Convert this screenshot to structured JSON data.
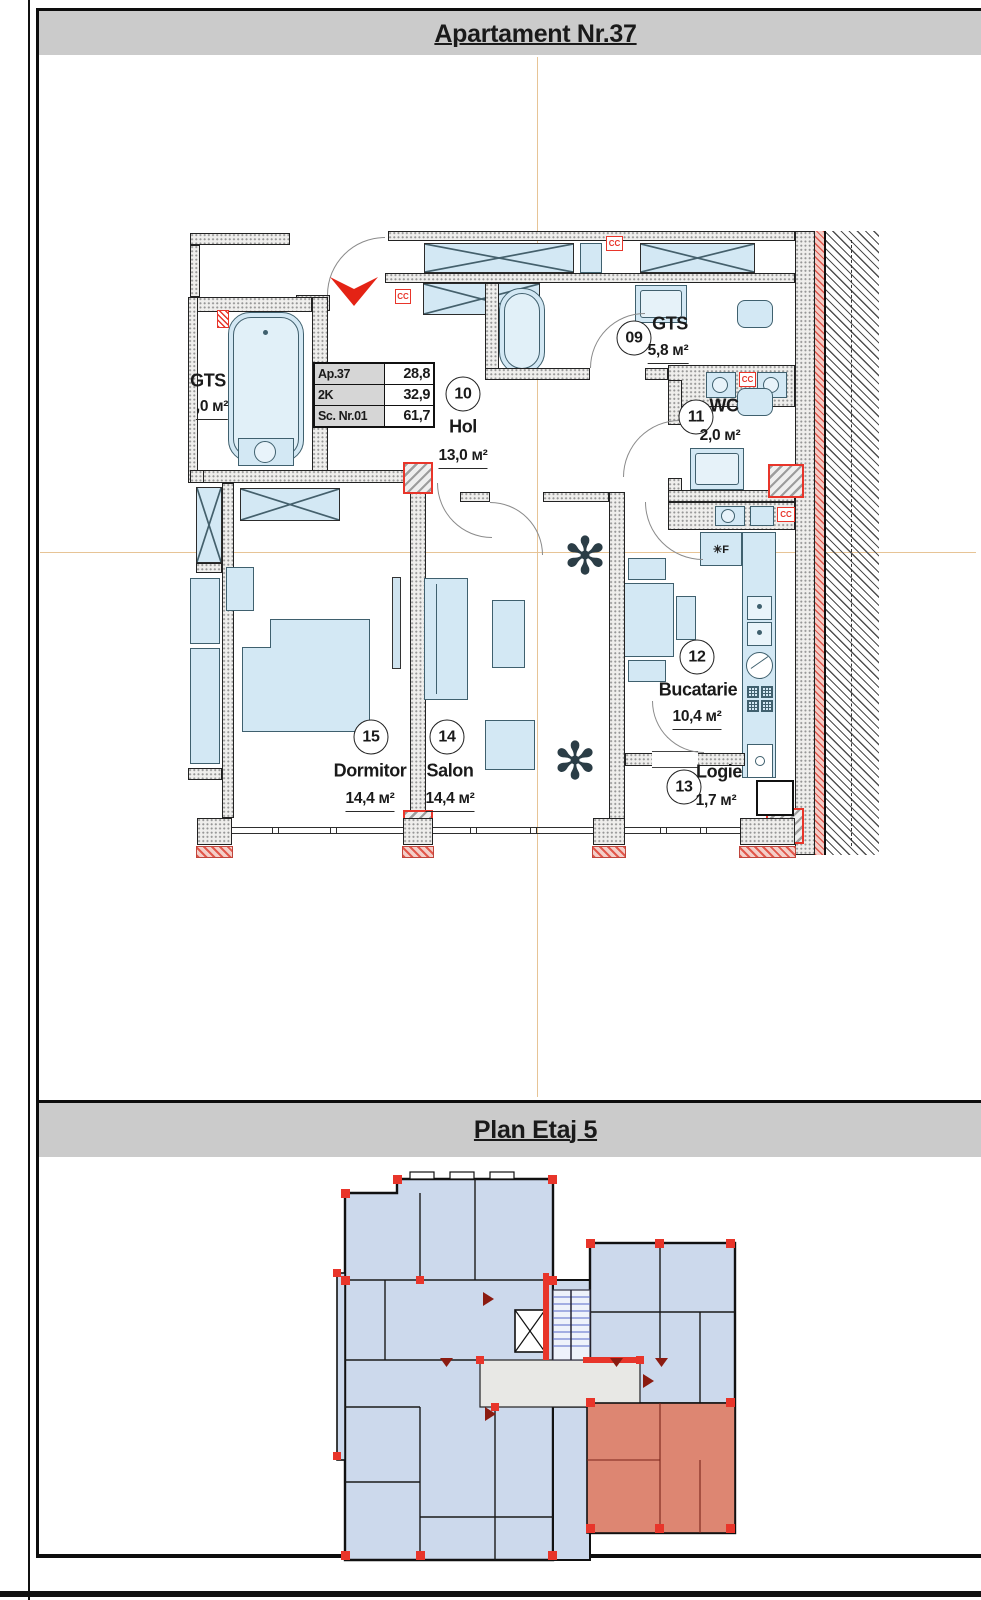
{
  "top": {
    "title": "Apartament Nr.37"
  },
  "bottom": {
    "title": "Plan Etaj 5"
  },
  "info_table": {
    "rows": [
      {
        "label": "Ap.37",
        "value": "28,8"
      },
      {
        "label": "2K",
        "value": "32,9"
      },
      {
        "label": "Sc. Nr.01",
        "value": "61,7"
      }
    ]
  },
  "rooms": [
    {
      "number": "09",
      "name": "GTS",
      "area": "5,8 м²"
    },
    {
      "number": "10",
      "name": "Hol",
      "area": "13,0 м²"
    },
    {
      "number": "11",
      "name": "WC",
      "area": "2,0 м²"
    },
    {
      "number": "12",
      "name": "Bucatarie",
      "area": "10,4 м²"
    },
    {
      "number": "13",
      "name": "Logie",
      "area": "1,7 м²"
    },
    {
      "number": "14",
      "name": "Salon",
      "area": "14,4 м²"
    },
    {
      "number": "15",
      "name": "Dormitor",
      "area": "14,4 м²"
    }
  ],
  "neighbor_room": {
    "name": "GTS",
    "area_visible": ",0 м²"
  },
  "fixtures": {
    "cc_label": "CC",
    "fridge_label": "✳F"
  },
  "icons": {
    "plant_glyph": "✻",
    "entrance_arrow": "red chevron down"
  },
  "colors": {
    "accent_red": "#e8352a",
    "fixture_blue": "#d3e8f4",
    "highlight_apartment": "#dd8672",
    "titlebar_gray": "#cbcbcb",
    "centerline_orange": "#e7c496",
    "miniplan_room_blue": "#ccd9ec",
    "stairs_blue": "#5568c8"
  }
}
